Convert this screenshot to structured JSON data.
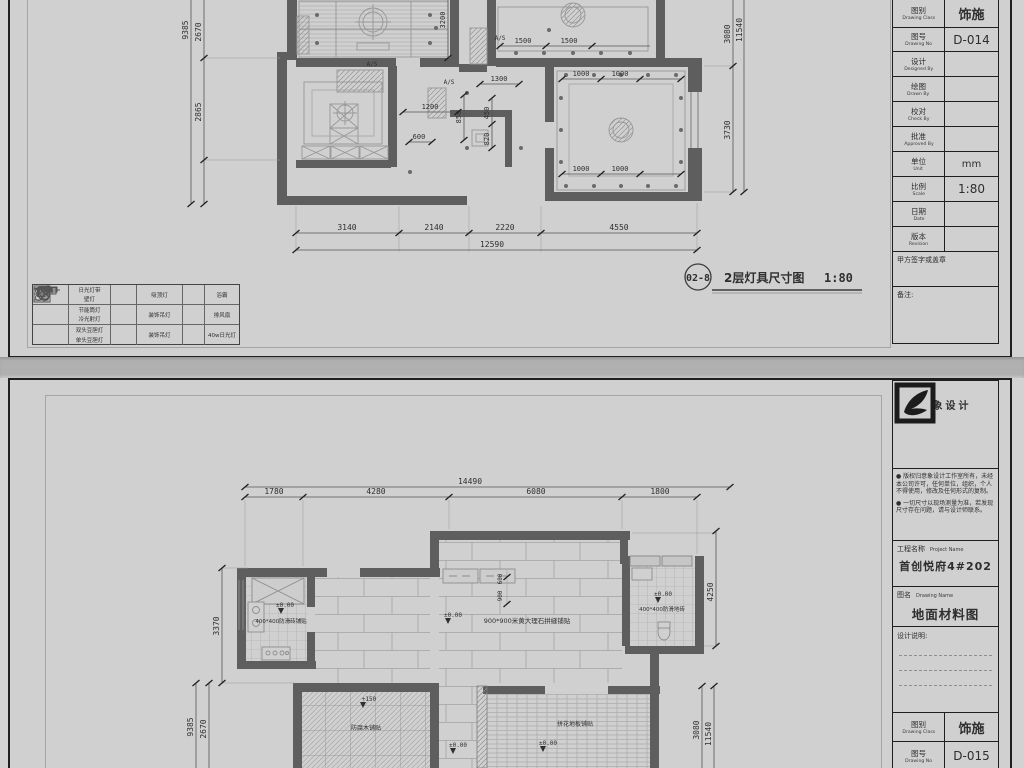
{
  "sheet1": {
    "drawing_title": {
      "number": "02-8",
      "name": "2层灯具尺寸图",
      "scale": "1:80"
    },
    "title_block": {
      "rows": [
        {
          "zh": "图别",
          "en": "Drawing Class",
          "value": "饰施"
        },
        {
          "zh": "图号",
          "en": "Drawing No",
          "value": "D-014"
        },
        {
          "zh": "设计",
          "en": "Designed By",
          "value": ""
        },
        {
          "zh": "绘图",
          "en": "Drawn By",
          "value": ""
        },
        {
          "zh": "校对",
          "en": "Check By",
          "value": ""
        },
        {
          "zh": "批准",
          "en": "Approved By",
          "value": ""
        },
        {
          "zh": "单位",
          "en": "Unit",
          "value": "mm"
        },
        {
          "zh": "比例",
          "en": "Scale",
          "value": "1:80"
        },
        {
          "zh": "日期",
          "en": "Date",
          "value": ""
        },
        {
          "zh": "版本",
          "en": "Revision",
          "value": ""
        }
      ],
      "signature_label": "甲方签字或盖章",
      "remarks_label": "备注:"
    },
    "legend": {
      "rows": [
        {
          "c1a": "日光灯带",
          "c1b": "壁灯",
          "c2": "吸顶灯",
          "c3": "浴霸"
        },
        {
          "c1a": "节能筒灯",
          "c1b": "冷光射灯",
          "c2": "装饰吊灯",
          "c3": "排风扇"
        },
        {
          "c1a": "双头豆胆灯",
          "c1b": "单头豆胆灯",
          "c2": "装饰吊灯",
          "c3": "40w日光灯"
        }
      ]
    },
    "dims": {
      "bottom": [
        "3140",
        "2140",
        "2220",
        "4550"
      ],
      "bottom_total": "12590",
      "left_total": "9385",
      "left": [
        "2670",
        "2865"
      ],
      "right_total": "11540",
      "right": [
        "3080",
        "3730"
      ],
      "interior": {
        "d1500a": "1500",
        "d1500b": "1500",
        "d1000a": "1000",
        "d1000b": "1000",
        "d1000c": "1000",
        "d1000d": "1000",
        "d1300": "1300",
        "d1200": "1200",
        "d3200": "3200",
        "d600a": "600",
        "d850": "850",
        "d450": "450",
        "d820": "820"
      },
      "as_label": "A/S"
    }
  },
  "sheet2": {
    "title_block": {
      "logo_text": "意象设计",
      "disclaimer1": "● 版权归意象设计工作室所有，未经本公司许可，任何单位，组织，个人不得使用，修改及任何形式的复制。",
      "disclaimer2": "● 一切尺寸以现场测量为准，若发现尺寸存在问题，请与设计师联系。",
      "project_label_zh": "工程名称",
      "project_label_en": "Project Name",
      "project_value": "首创悦府4#202",
      "drawing_label_zh": "图名",
      "drawing_label_en": "Drawing Name",
      "drawing_value": "地面材料图",
      "notes_label": "设计说明:",
      "class_zh": "图别",
      "class_en": "Drawing Class",
      "class_value": "饰施",
      "no_zh": "图号",
      "no_en": "Drawing No",
      "no_value": "D-015"
    },
    "dims": {
      "top": [
        "1780",
        "4280",
        "6080",
        "1800"
      ],
      "top_total": "14490",
      "left_seg": "3370",
      "left_outer": "9385",
      "left_inner": "2670",
      "right_seg": "4250",
      "right_inner": "3080",
      "right_outer": "11540",
      "interior": {
        "d900": "900",
        "d600": "600"
      }
    },
    "labels": {
      "level_zero": "±0.00",
      "level_150": "+150",
      "kitchen_floor": "400*400防滑砖铺贴",
      "living_floor": "900*900米黄大理石拼缝铺贴",
      "bath_floor": "400*400防滑地砖",
      "balcony_floor": "防腐木铺贴",
      "bedroom_floor": "拼花地板铺贴"
    }
  }
}
